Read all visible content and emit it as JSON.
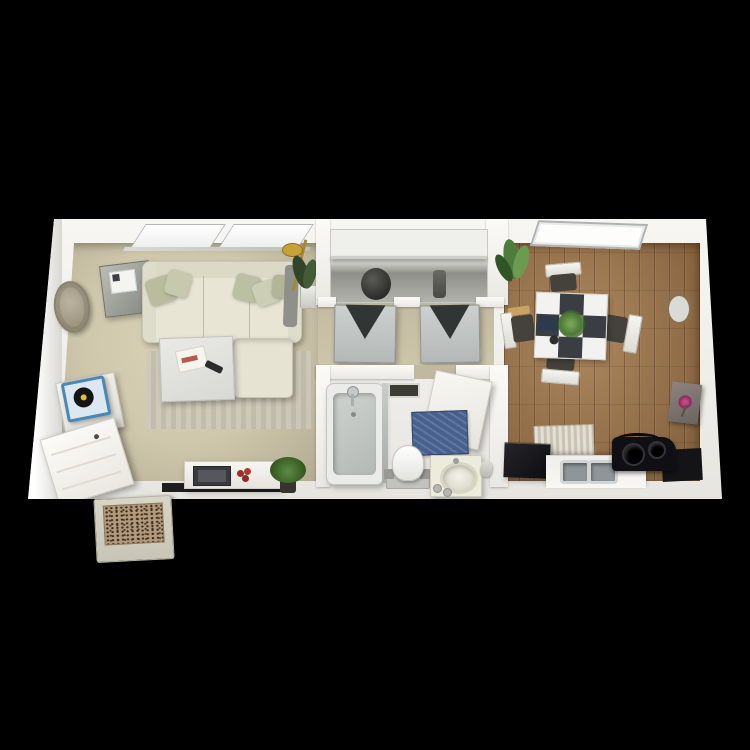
{
  "scene": {
    "kind": "3d-rendered-apartment-floor-plan-top-view",
    "background_color": "#000000",
    "visible_text": [],
    "palette": {
      "walls": "#f3f2ee",
      "carpet": "#cdc6ab",
      "hardwood": "#9b7146",
      "bathroom_tile": "#d2cbbb",
      "sofa": "#e8e5d5",
      "pillow_sage": "#b9bd9e",
      "closet_door": "#c0c4c3",
      "bath_mat_blue": "#47618f",
      "table_checker_dark": "#3a3d42",
      "appliance_black": "#121215",
      "doormat_brown": "#b29a7c",
      "lamp_gold": "#c7a23b",
      "plant_green": "#4e7c3a"
    },
    "rooms": [
      {
        "name": "living-room",
        "floor": "carpet",
        "items": [
          "double-window",
          "sectional-sofa",
          "throw-pillows",
          "gray-side-cabinet",
          "woven-wall-decor",
          "arc-floor-lamp",
          "corner-potted-plant",
          "coffee-table",
          "magazine",
          "remote-control",
          "striped-area-rug",
          "record-player",
          "record-cabinet",
          "open-entry-door",
          "media-console",
          "tv",
          "red-flowers",
          "console-potted-plant"
        ]
      },
      {
        "name": "hallway-closet",
        "floor": "carpet",
        "items": [
          "closet-shelf",
          "bifold-door-left",
          "bifold-door-right",
          "laundry-hamper",
          "closet-vase"
        ]
      },
      {
        "name": "bathroom",
        "floor": "tile",
        "items": [
          "bathtub",
          "tub-faucet",
          "shower-curtain",
          "ceiling-vent",
          "blue-bath-mat",
          "toilet",
          "open-bathroom-door",
          "vanity-with-round-sink",
          "towel-holder"
        ]
      },
      {
        "name": "dining-kitchen",
        "floor": "hardwood",
        "items": [
          "window",
          "checkerboard-dining-table",
          "dining-chair-top",
          "dining-chair-bottom",
          "dining-chair-left",
          "dining-chair-right",
          "table-centerpiece-plant",
          "corner-potted-plant",
          "wicker-round-mirror",
          "flower-wall-art",
          "black-refrigerator",
          "kitchen-counter",
          "double-basin-sink",
          "black-cooktop-stove",
          "striped-kitchen-mat",
          "dark-corner-counter"
        ]
      }
    ],
    "outside": [
      {
        "name": "entry-doormat",
        "pattern": "dark-speckle",
        "border_color": "#d4cfc0"
      }
    ]
  }
}
